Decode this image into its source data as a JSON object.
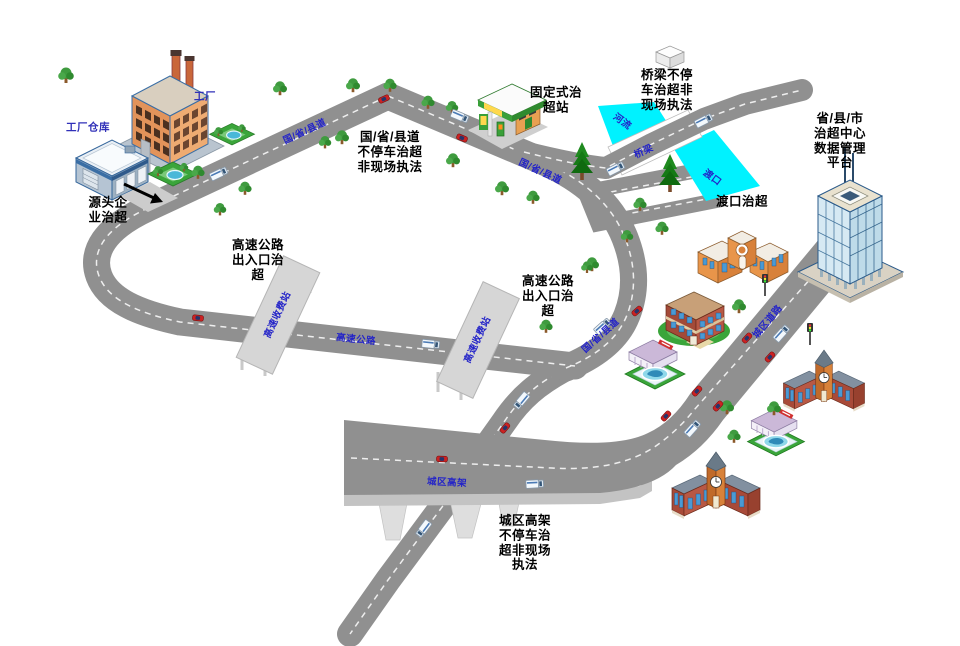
{
  "colors": {
    "background": "#ffffff",
    "road": "#909090",
    "road_dash": "#ffffff",
    "water": "#00f2ff",
    "canopy": "#d6d6d6",
    "viaduct_side": "#c3c3c3",
    "pier": "#dedede",
    "label_text": "#000000",
    "road_label_text": "#2323c8",
    "site_label_text": "#3030b8",
    "tree": "#3f9b3f",
    "pine": "#157a15",
    "grass": "#3aa53a",
    "car": "#cc2222",
    "truck": "#f3f8fc"
  },
  "labels": {
    "factory": "工厂",
    "warehouse": "工厂仓库",
    "source_enterprise": "源头企\n业治超",
    "road_nonstop": "国/省/县道\n不停车治超\n非现场执法",
    "fixed_station": "固定式治\n超站",
    "bridge_nonstop": "桥梁不停\n车治超非\n现场执法",
    "ferry_control": "渡口治超",
    "platform": "省/县/市\n治超中心\n数据管理\n平台",
    "highway_exit_left": "高速公路\n出入口治\n超",
    "highway_exit_right": "高速公路\n出入口治\n超",
    "viaduct_nonstop": "城区高架\n不停车治\n超非现场\n执法"
  },
  "road_labels": {
    "national_road_1": "国/省/县道",
    "national_road_2": "国/省/县道",
    "national_road_3": "国/省/县道",
    "highway": "高速公路",
    "toll_station_1": "高速收费站",
    "toll_station_2": "高速收费站",
    "bridge": "桥梁",
    "river": "河流",
    "ferry_dock": "渡口",
    "viaduct": "城区高架",
    "urban_road": "城区道路"
  }
}
